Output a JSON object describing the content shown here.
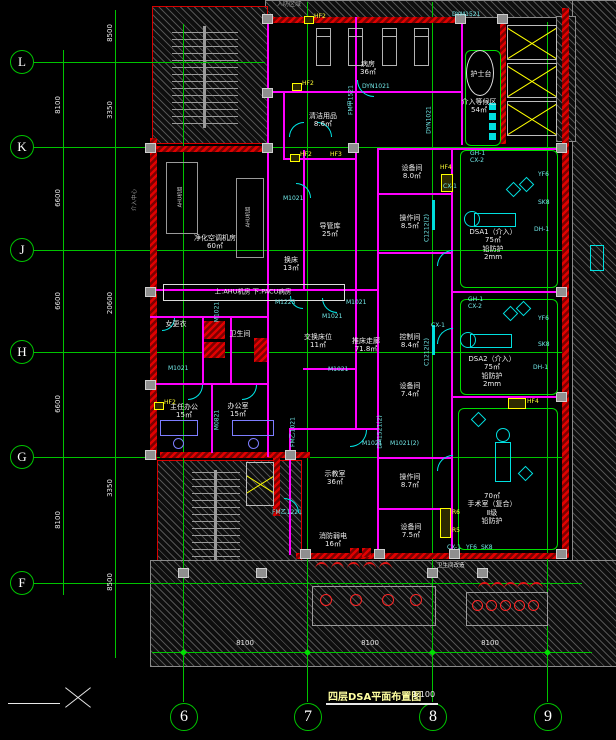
{
  "meta": {
    "title": "四层DSA平面布置图",
    "scale": "1:100"
  },
  "grid": {
    "rows": [
      "L",
      "K",
      "J",
      "H",
      "G",
      "F"
    ],
    "cols": [
      "6",
      "7",
      "8",
      "9"
    ]
  },
  "dims": {
    "left_outer": [
      "8100",
      "6600",
      "6600",
      "6600",
      "8100"
    ],
    "left_inner": [
      "8500",
      "3350",
      "20600",
      "3350",
      "8500"
    ],
    "bottom": [
      "8100",
      "8100",
      "8100"
    ]
  },
  "notes": {
    "civil_defense": "人防区域",
    "department": "介入中心",
    "level": "上:AHU机房  下:PACU病房",
    "renovation": "卫生间改造"
  },
  "colors": {
    "grid": "#00c400",
    "wall_red": "#e00000",
    "wall_magenta": "#ff00ff",
    "door_cyan": "#00e5e5",
    "tag_yellow": "#ffff00",
    "shield_green": "#00dd00"
  },
  "rooms": [
    {
      "n": "病房",
      "a": "36㎡"
    },
    {
      "n": "清洁用品",
      "a": "8.6㎡"
    },
    {
      "n": "介入等候区",
      "a": "54㎡"
    },
    {
      "n": "护士台",
      "a": ""
    },
    {
      "n": "设备间",
      "a": "8.0㎡"
    },
    {
      "n": "操作间",
      "a": "8.5㎡"
    },
    {
      "n": "净化空调机房",
      "a": "60㎡"
    },
    {
      "n": "导管库",
      "a": "25㎡"
    },
    {
      "n": "换床",
      "a": "13㎡"
    },
    {
      "n": "女更衣",
      "a": ""
    },
    {
      "n": "卫生间",
      "a": ""
    },
    {
      "n": "交换床位",
      "a": "11㎡"
    },
    {
      "n": "推床走廊",
      "a": "71.8㎡"
    },
    {
      "n": "控制间",
      "a": "8.4㎡"
    },
    {
      "n": "设备间",
      "a": "7.4㎡"
    },
    {
      "n": "主任办公",
      "a": "15㎡"
    },
    {
      "n": "办公室",
      "a": "15㎡"
    },
    {
      "n": "示教室",
      "a": "36㎡"
    },
    {
      "n": "操作间",
      "a": "8.7㎡"
    },
    {
      "n": "设备间",
      "a": "7.5㎡"
    },
    {
      "n": "消防弱电",
      "a": "16㎡"
    }
  ],
  "dsa1": {
    "l1": "DSA1（介入）",
    "l2": "75㎡",
    "l3": "铅防护",
    "l4": "2mm"
  },
  "dsa2": {
    "l1": "DSA2（介入）",
    "l2": "75㎡",
    "l3": "铅防护",
    "l4": "2mm"
  },
  "or": {
    "l1": "70㎡",
    "l2": "手术室（复合）",
    "l3": "Ⅱ级",
    "l4": "铅防护"
  },
  "ahu": {
    "u1": "AHU机组",
    "u2": "AHU机组"
  },
  "door_labels": [
    {
      "t": "FM甲1521"
    },
    {
      "t": "M1021"
    },
    {
      "t": "DYN1021"
    },
    {
      "t": "DYN1021"
    },
    {
      "t": "DYM1521"
    },
    {
      "t": "M1021"
    },
    {
      "t": "M1021"
    },
    {
      "t": "M1021"
    },
    {
      "t": "M1021"
    },
    {
      "t": "M0821"
    },
    {
      "t": "M1223"
    },
    {
      "t": "FM乙1021"
    },
    {
      "t": "M1021"
    },
    {
      "t": "M1021(2)"
    },
    {
      "t": "DM1521(2)"
    },
    {
      "t": "FM乙1221"
    },
    {
      "t": "C1212(2)"
    },
    {
      "t": "C1212(2)"
    },
    {
      "t": "M1021"
    }
  ],
  "tags": [
    {
      "t": "HF2"
    },
    {
      "t": "HF2"
    },
    {
      "t": "HF2"
    },
    {
      "t": "HF3"
    },
    {
      "t": "HF4"
    },
    {
      "t": "HF4"
    },
    {
      "t": "R6"
    },
    {
      "t": "R5"
    },
    {
      "t": "HF2"
    }
  ],
  "equip_tags": [
    {
      "t": "GH-1"
    },
    {
      "t": "CX-2"
    },
    {
      "t": "YF6"
    },
    {
      "t": "SK8"
    },
    {
      "t": "DH-1"
    },
    {
      "t": "CX-1"
    },
    {
      "t": "GH-1"
    },
    {
      "t": "CX-2"
    },
    {
      "t": "YF6"
    },
    {
      "t": "SK8"
    },
    {
      "t": "DH-1"
    },
    {
      "t": "CX-1"
    },
    {
      "t": "CX-1"
    },
    {
      "t": "YF6"
    },
    {
      "t": "SK8"
    }
  ]
}
